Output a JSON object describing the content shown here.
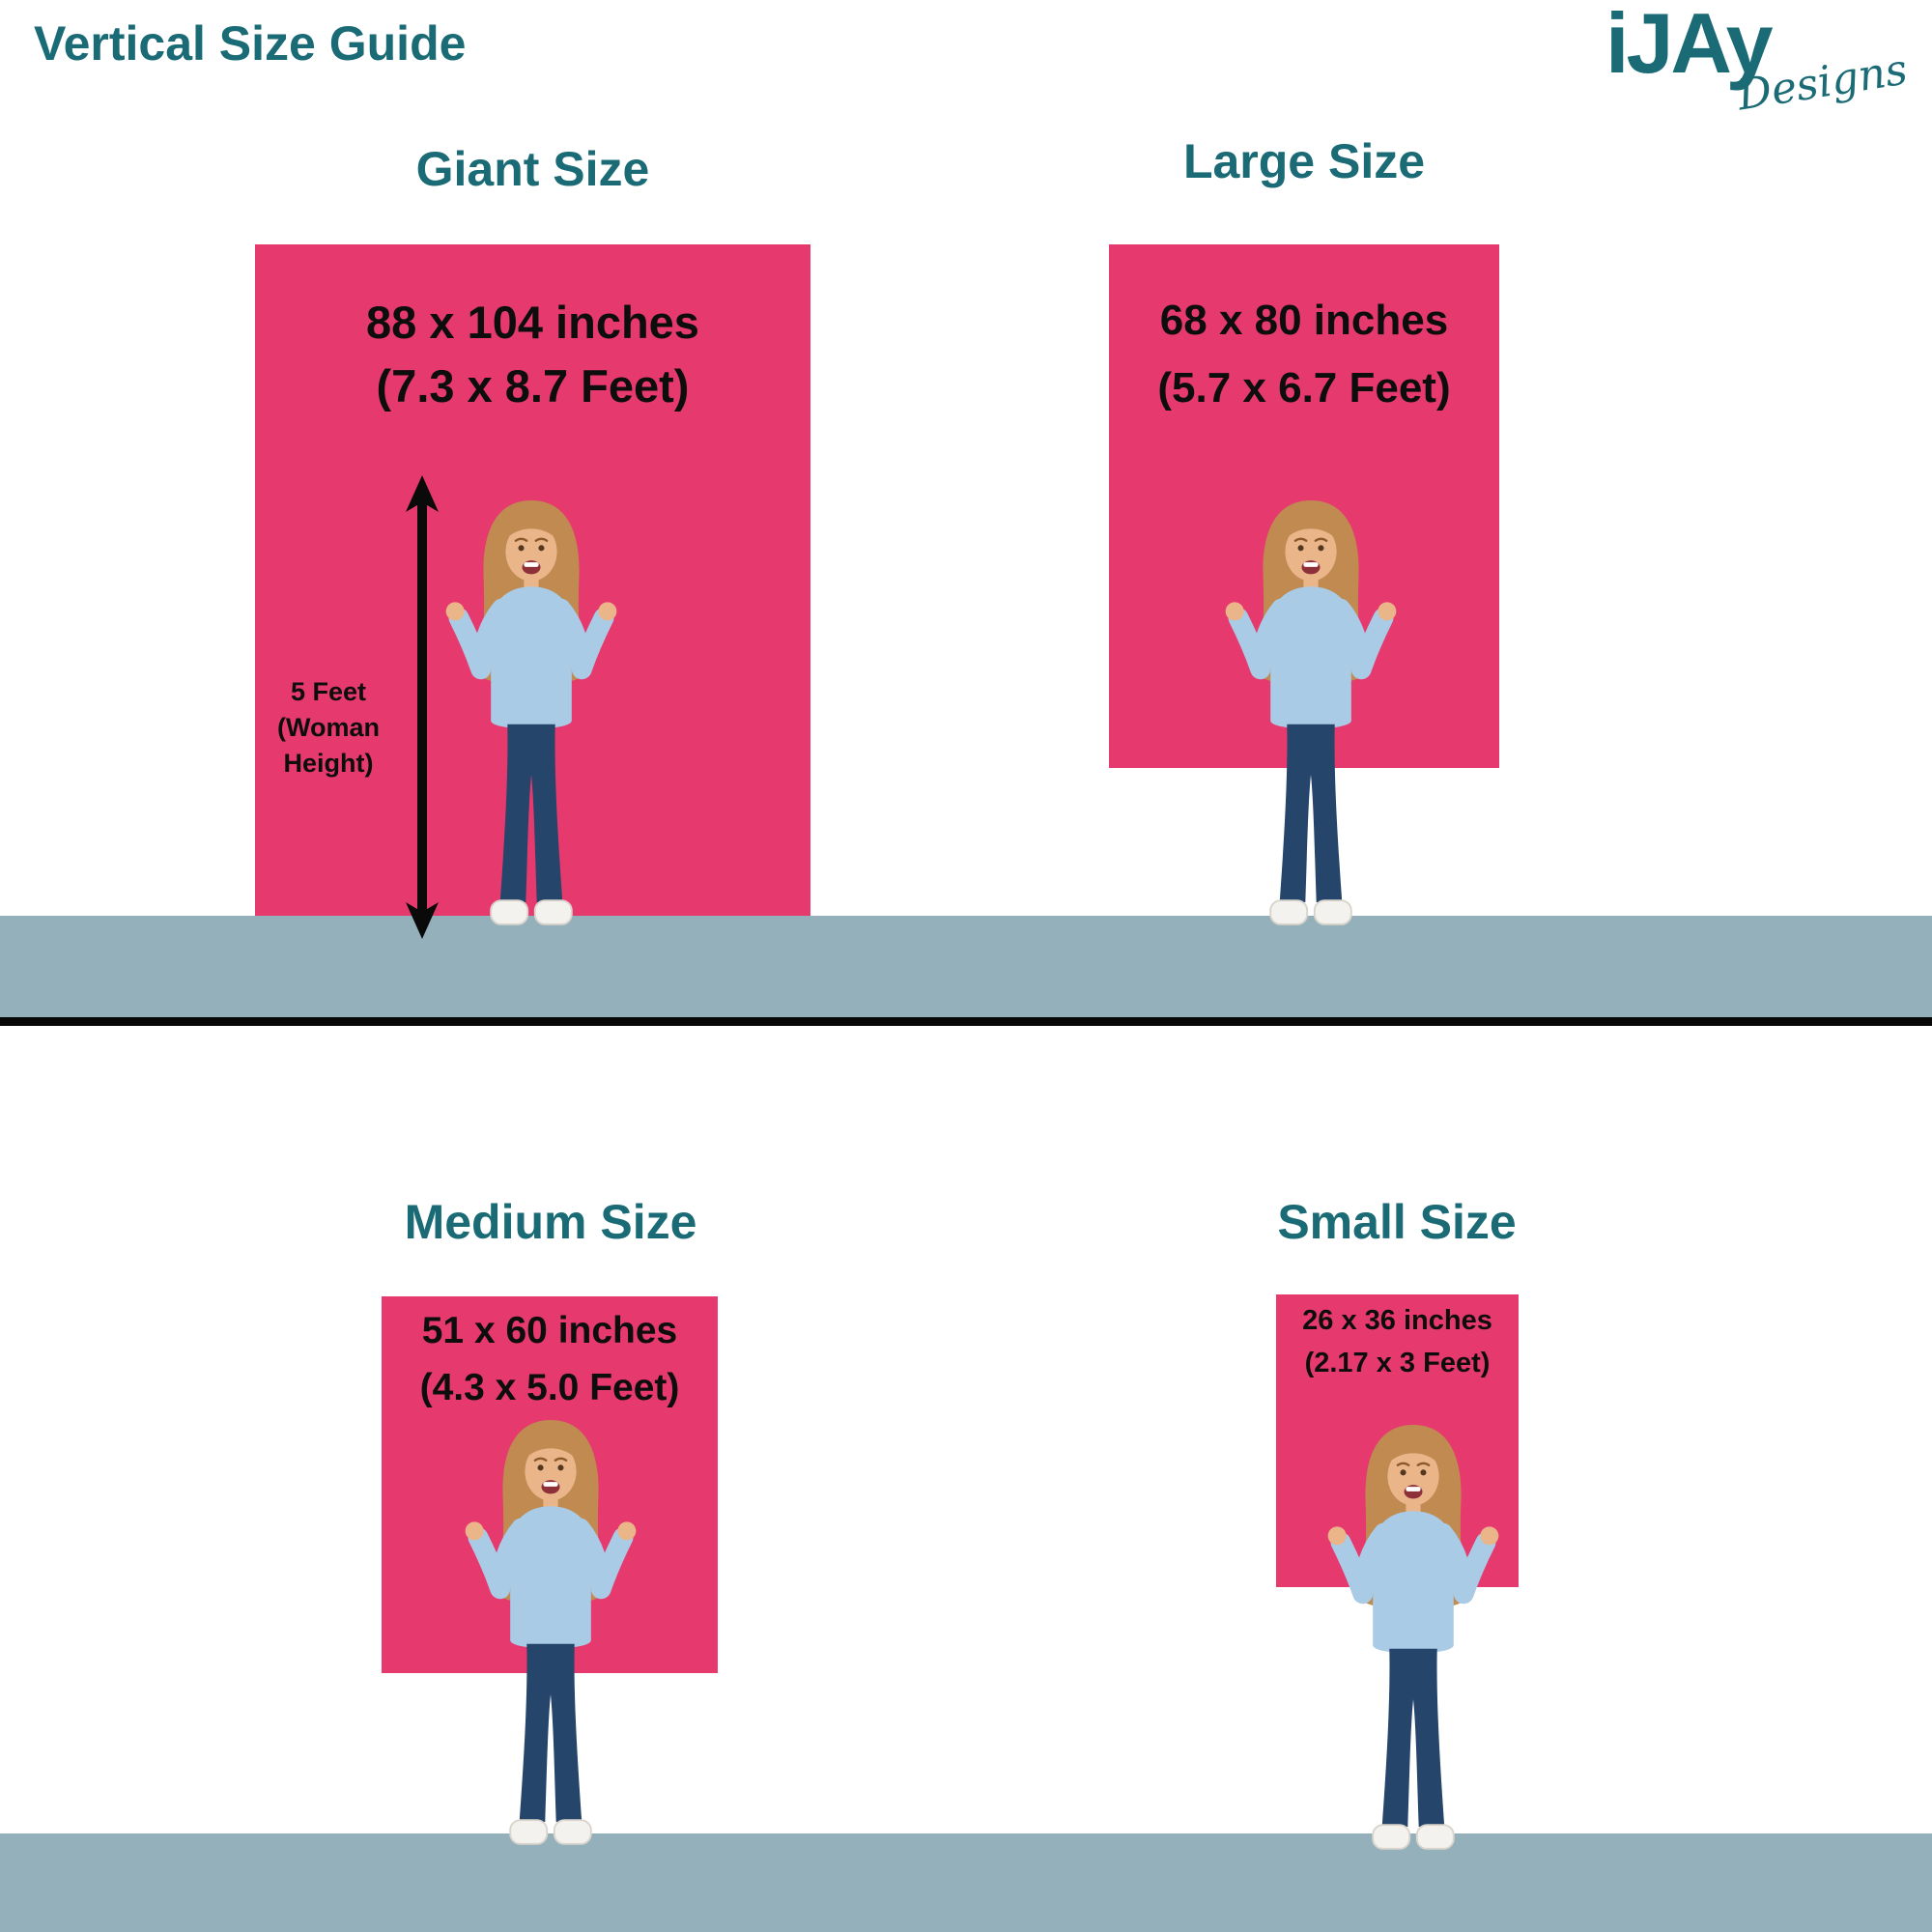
{
  "header": {
    "title": "Vertical Size Guide",
    "logo": {
      "brand": "iJAy",
      "tagline": "Designs"
    }
  },
  "sizes": [
    {
      "name": "Giant Size",
      "dimensions_inches": "88 x 104 inches",
      "dimensions_feet": "(7.3 x 8.7 Feet)"
    },
    {
      "name": "Large Size",
      "dimensions_inches": "68 x 80 inches",
      "dimensions_feet": "(5.7 x 6.7 Feet)"
    },
    {
      "name": "Medium Size",
      "dimensions_inches": "51 x 60 inches",
      "dimensions_feet": "(4.3 x 5.0 Feet)"
    },
    {
      "name": "Small Size",
      "dimensions_inches": "26 x 36 inches",
      "dimensions_feet": "(2.17 x 3 Feet)"
    }
  ],
  "height_annotation": {
    "line1": "5 Feet",
    "line2": "(Woman",
    "line3": "Height)"
  },
  "colors": {
    "teal": "#1A6B75",
    "pink": "#E63A6F",
    "floor": "#93B0BB",
    "ink": "#0d0d0d",
    "sweater": "#A9CBE6",
    "jeans": "#25456B",
    "hair": "#C08A51",
    "skin": "#EBB58A",
    "shoe": "#F4F2EE"
  }
}
